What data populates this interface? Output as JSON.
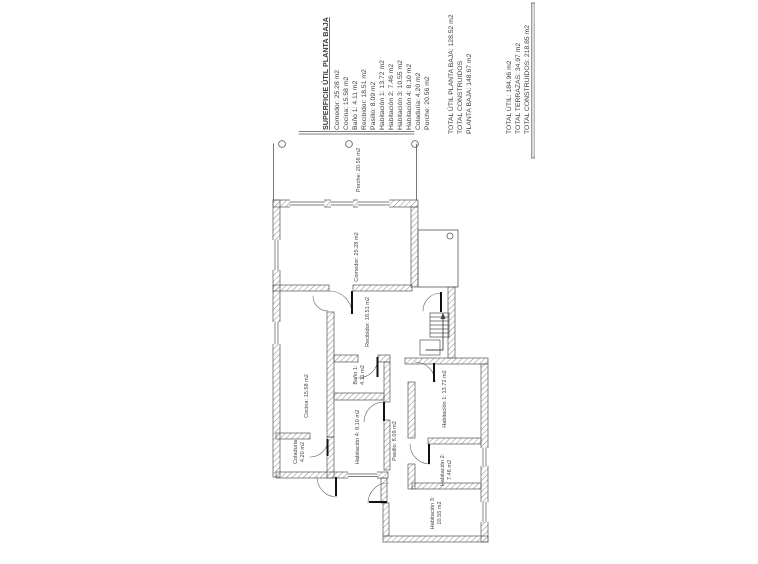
{
  "document": {
    "legend": {
      "title": "SUPERFICIE ÚTIL PLANTA BAJA",
      "items": [
        "Comedor: 25.28 m2",
        "Cocina: 15.58 m2",
        "Baño 1: 4.11 m2",
        "Recibidor: 18.51 m2",
        "Pasillo: 8.09 m2",
        "Habitación 1: 13.72 m2",
        "Habitación 2: 7.46 m2",
        "Habitación 3: 10.55 m2",
        "Habitación 4: 8.10 m2",
        "Coladuria: 4.20 m2",
        "Porche: 20.56 m2"
      ],
      "totals_block1": [
        "TOTAL ÚTIL PLANTA BAJA: 128.52 m2",
        "TOTAL CONSTRUIDOS",
        "PLANTA BAJA: 148.67 m2"
      ],
      "totals_block2": [
        "TOTAL ÚTIL: 184.96 m2",
        "TOTAL TERRAZAS: 34.97 m2",
        "TOTAL CONSTRUIDOS: 218.85 m2"
      ]
    },
    "plan_labels": {
      "porche": "Porche: 20.56 m2",
      "comedor": "Comedor: 25.28 m2",
      "recibidor": "Recibidor: 18.51 m2",
      "cocina": "Cocina: 15.58 m2",
      "bano1_line1": "Baño 1:",
      "bano1_line2": "4.11 m2",
      "habitacion1": "Habitación 1: 13.72 m2",
      "habitacion2_line1": "Habitación 2:",
      "habitacion2_line2": "7.46 m2",
      "habitacion3_line1": "Habitación 3:",
      "habitacion3_line2": "10.55 m2",
      "habitacion4": "Habitación 4: 8.10 m2",
      "pasillo": "Pasillo: 8.09 m2",
      "coladuria_line1": "Coladuria",
      "coladuria_line2": "4.20 m2"
    },
    "colors": {
      "paper": "#ffffff",
      "ink": "#3c3c3c",
      "wall_hatch": "#8a8a8a",
      "wall_outline": "#555555"
    }
  }
}
